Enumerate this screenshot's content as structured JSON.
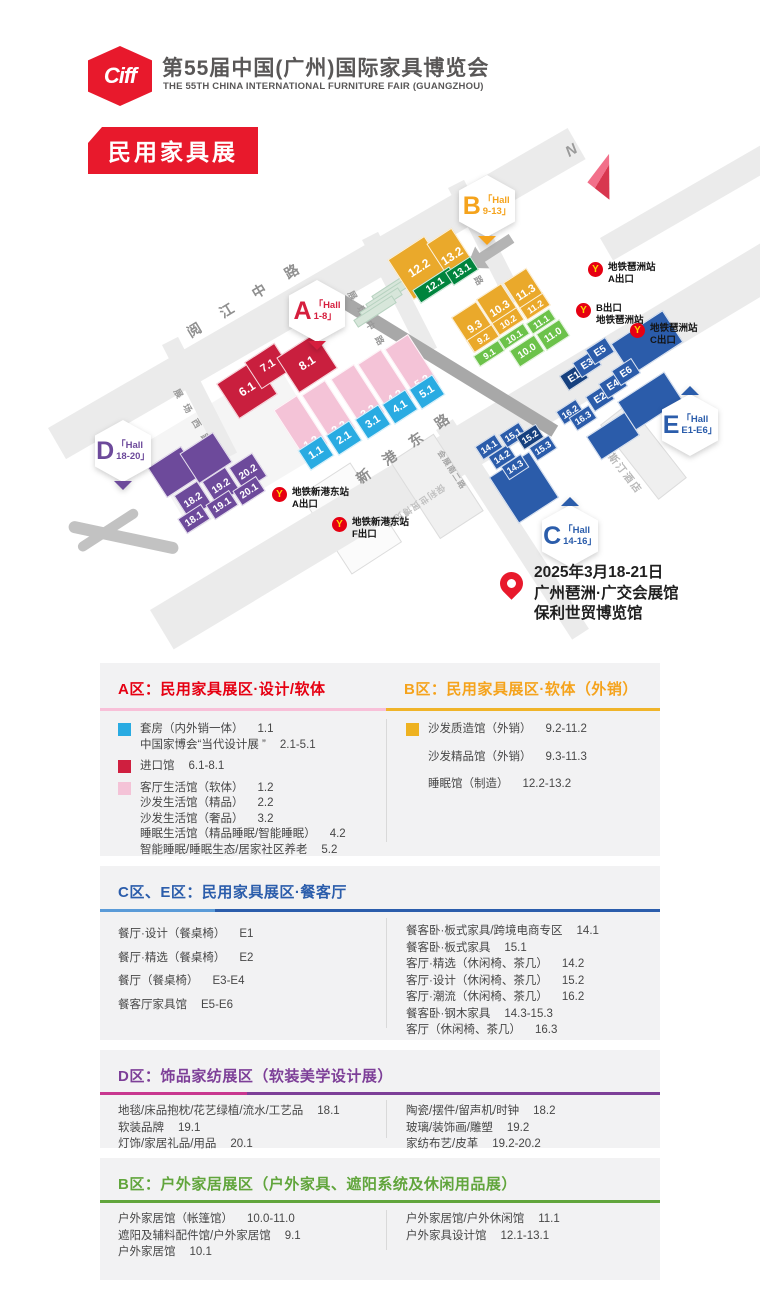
{
  "header": {
    "logo": "Ciff",
    "title": "第55届中国(广州)国际家具博览会",
    "subtitle": "THE 55TH CHINA INTERNATIONAL FURNITURE FAIR (GUANGZHOU)",
    "banner": "民用家具展"
  },
  "map": {
    "north": "N",
    "metro_icon": "Y",
    "badges": {
      "a": {
        "letter": "A",
        "line1": "「Hall",
        "line2": "1-8」"
      },
      "b": {
        "letter": "B",
        "line1": "「Hall",
        "line2": "9-13」"
      },
      "c": {
        "letter": "C",
        "line1": "「Hall",
        "line2": "14-16」"
      },
      "d": {
        "letter": "D",
        "line1": "「Hall",
        "line2": "18-20」"
      },
      "e": {
        "letter": "E",
        "line1": "「Hall",
        "line2": "E1-E6」"
      }
    },
    "roads": {
      "yuejiang": "阅 江 中 路",
      "xingang": "新 港 东 路",
      "zhanchang_dong": "展 场 东 路",
      "zhanchang_zhong": "展 场 中 路",
      "zhanchang_xi": "展 场 西 路",
      "huizhan_nan": "会展南二路"
    },
    "buildings": {
      "westin": "威斯汀酒店",
      "poly": "保利世贸博览馆"
    },
    "metro": {
      "pazhou_a": {
        "line1": "地铁琶洲站",
        "line2": "A出口"
      },
      "pazhou_b": {
        "line1": "B出口",
        "line2": "地铁琶洲站"
      },
      "pazhou_c": {
        "line1": "地铁琶洲站",
        "line2": "C出口"
      },
      "xingang_a": {
        "line1": "地铁新港东站",
        "line2": "A出口"
      },
      "xingang_f": {
        "line1": "地铁新港东站",
        "line2": "F出口"
      }
    },
    "venue": {
      "date": "2025年3月18-21日",
      "line2": "广州琶洲·广交会展馆",
      "line3": "保利世贸博览馆"
    },
    "hall_labels": {
      "h61": "6.1",
      "h71": "7.1",
      "h81": "8.1",
      "h12": "1.2",
      "h22": "2.2",
      "h32": "3.2",
      "h42": "4.2",
      "h52": "5.2",
      "h11": "1.1",
      "h21": "2.1",
      "h31": "3.1",
      "h41": "4.1",
      "h51": "5.1",
      "h182": "18.2",
      "h192": "19.2",
      "h202": "20.2",
      "h181": "18.1",
      "h191": "19.1",
      "h201": "20.1",
      "h122": "12.2",
      "h132": "13.2",
      "h121": "12.1",
      "h131": "13.1",
      "h93": "9.3",
      "h103": "10.3",
      "h113": "11.3",
      "h92": "9.2",
      "h102": "10.2",
      "h112": "11.2",
      "h91": "9.1",
      "h101": "10.1",
      "h111": "11.1",
      "h100": "10.0",
      "h110": "11.0",
      "e1": "E1",
      "e2": "E2",
      "e3": "E3",
      "e4": "E4",
      "e5": "E5",
      "e6": "E6",
      "c141": "14.1",
      "c142": "14.2",
      "c143": "14.3",
      "c151": "15.1",
      "c152": "15.2",
      "c153": "15.3",
      "c162": "16.2",
      "c163": "16.3"
    }
  },
  "legend": {
    "a": {
      "title": "A区：民用家具展区·设计/软体",
      "items": [
        {
          "text": "套房（内外销一体）",
          "code": "1.1"
        },
        {
          "text": "中国家博会“当代设计展 ”",
          "code": "2.1-5.1"
        },
        {
          "text": "进口馆",
          "code": "6.1-8.1"
        },
        {
          "text": "客厅生活馆（软体）",
          "code": "1.2"
        },
        {
          "text": "沙发生活馆（精品）",
          "code": "2.2"
        },
        {
          "text": "沙发生活馆（奢品）",
          "code": "3.2"
        },
        {
          "text": "睡眠生活馆（精品睡眠/智能睡眠）",
          "code": "4.2"
        },
        {
          "text": "智能睡眠/睡眠生态/居家社区养老",
          "code": "5.2"
        }
      ]
    },
    "b": {
      "title": "B区：民用家具展区·软体（外销）",
      "items": [
        {
          "text": "沙发质造馆（外销）",
          "code": "9.2-11.2"
        },
        {
          "text": "沙发精品馆（外销）",
          "code": "9.3-11.3"
        },
        {
          "text": "睡眠馆（制造）",
          "code": "12.2-13.2"
        }
      ]
    },
    "ce": {
      "title": "C区、E区：民用家具展区·餐客厅",
      "left": [
        {
          "text": "餐厅·设计（餐桌椅）",
          "code": "E1"
        },
        {
          "text": "餐厅·精选（餐桌椅）",
          "code": "E2"
        },
        {
          "text": "餐厅（餐桌椅）",
          "code": "E3-E4"
        },
        {
          "text": "餐客厅家具馆",
          "code": "E5-E6"
        }
      ],
      "right": [
        {
          "text": "餐客卧·板式家具/跨境电商专区",
          "code": "14.1"
        },
        {
          "text": "餐客卧·板式家具",
          "code": "15.1"
        },
        {
          "text": "客厅·精选（休闲椅、茶几）",
          "code": "14.2"
        },
        {
          "text": "客厅·设计（休闲椅、茶几）",
          "code": "15.2"
        },
        {
          "text": "客厅·潮流（休闲椅、茶几）",
          "code": "16.2"
        },
        {
          "text": "餐客卧·钢木家具",
          "code": "14.3-15.3"
        },
        {
          "text": "客厅（休闲椅、茶几）",
          "code": "16.3"
        }
      ]
    },
    "d": {
      "title": "D区：饰品家纺展区（软装美学设计展）",
      "left": [
        {
          "text": "地毯/床品抱枕/花艺绿植/流水/工艺品",
          "code": "18.1"
        },
        {
          "text": "软装品牌",
          "code": "19.1"
        },
        {
          "text": "灯饰/家居礼品/用品",
          "code": "20.1"
        }
      ],
      "right": [
        {
          "text": "陶瓷/摆件/留声机/时钟",
          "code": "18.2"
        },
        {
          "text": "玻璃/装饰画/雕塑",
          "code": "19.2"
        },
        {
          "text": "家纺布艺/皮革",
          "code": "19.2-20.2"
        }
      ]
    },
    "b2": {
      "title": "B区：户外家居展区（户外家具、遮阳系统及休闲用品展）",
      "left": [
        {
          "text": "户外家居馆（帐篷馆）",
          "code": "10.0-11.0"
        },
        {
          "text": "遮阳及辅料配件馆/户外家居馆",
          "code": "9.1"
        },
        {
          "text": "户外家居馆",
          "code": "10.1"
        }
      ],
      "right": [
        {
          "text": "户外家居馆/户外休闲馆",
          "code": "11.1"
        },
        {
          "text": "户外家具设计馆",
          "code": "12.1-13.1"
        }
      ]
    }
  },
  "colors": {
    "brand_red": "#e8192c",
    "hall_red": "#c91f3e",
    "hall_pink": "#f4c3d7",
    "hall_blue": "#29abe2",
    "hall_yellow": "#eaa92b",
    "hall_green": "#6cc24a",
    "hall_dark_green": "#00843d",
    "hall_purple": "#6d4a9b",
    "hall_navy": "#2b5caa",
    "hall_dark_navy": "#16407e",
    "accent_a": "#e60012",
    "accent_b": "#f5a31c",
    "accent_ce": "#2b5dab",
    "accent_d": "#7d3f98",
    "accent_b2": "#61a53c",
    "metro_red": "#e60012",
    "metro_yellow": "#ffd800"
  }
}
